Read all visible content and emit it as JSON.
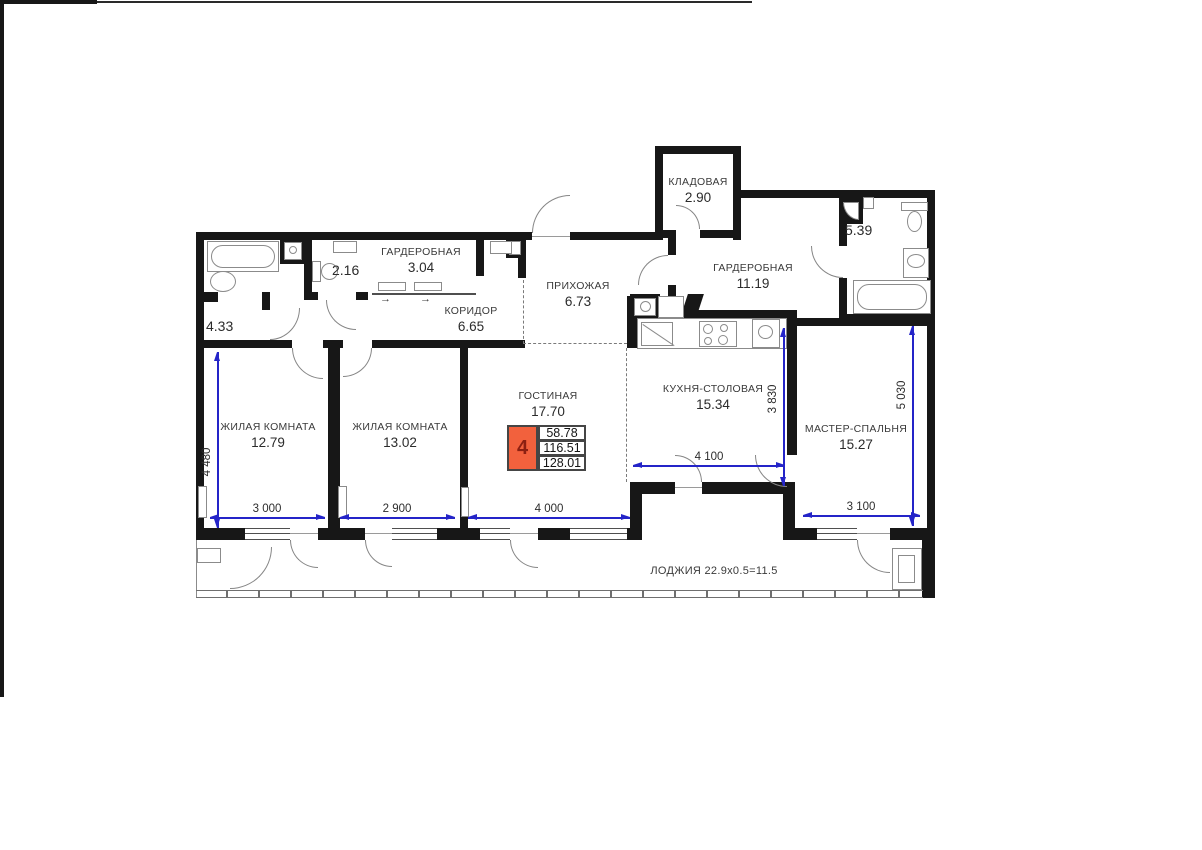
{
  "plan": {
    "title": "apartment floor plan",
    "rooms": [
      {
        "name": "КЛАДОВАЯ",
        "area": "2.90"
      },
      {
        "name": "ГАРДЕРОБНАЯ",
        "area": "3.04"
      },
      {
        "name": "",
        "area": "2.16"
      },
      {
        "name": "",
        "area": "4.33"
      },
      {
        "name": "ПРИХОЖАЯ",
        "area": "6.73"
      },
      {
        "name": "КОРИДОР",
        "area": "6.65"
      },
      {
        "name": "ГАРДЕРОБНАЯ",
        "area": "11.19"
      },
      {
        "name": "",
        "area": "5.39"
      },
      {
        "name": "ЖИЛАЯ КОМНАТА",
        "area": "12.79"
      },
      {
        "name": "ЖИЛАЯ КОМНАТА",
        "area": "13.02"
      },
      {
        "name": "ГОСТИНАЯ",
        "area": "17.70"
      },
      {
        "name": "КУХНЯ-СТОЛОВАЯ",
        "area": "15.34"
      },
      {
        "name": "МАСТЕР-СПАЛЬНЯ",
        "area": "15.27"
      }
    ],
    "loggia_label": "ЛОДЖИЯ 22.9x0.5=11.5",
    "info_box": {
      "rooms_count": "4",
      "row1": "58.78",
      "row2": "116.51",
      "row3": "128.01"
    },
    "dimensions": {
      "room1_width": "3 000",
      "room2_width": "2 900",
      "lounge_width": "4 000",
      "master_width": "3 100",
      "kitchen_width": "4 100",
      "room1_height": "4 480",
      "kitchen_height": "3 830",
      "master_height": "5 030"
    },
    "wardrobe_arrow": "→",
    "colors": {
      "wall": "#171717",
      "dimension_blue": "#2424c8",
      "info_orange": "#f2613d",
      "info_digit_red": "#8c2012"
    }
  }
}
